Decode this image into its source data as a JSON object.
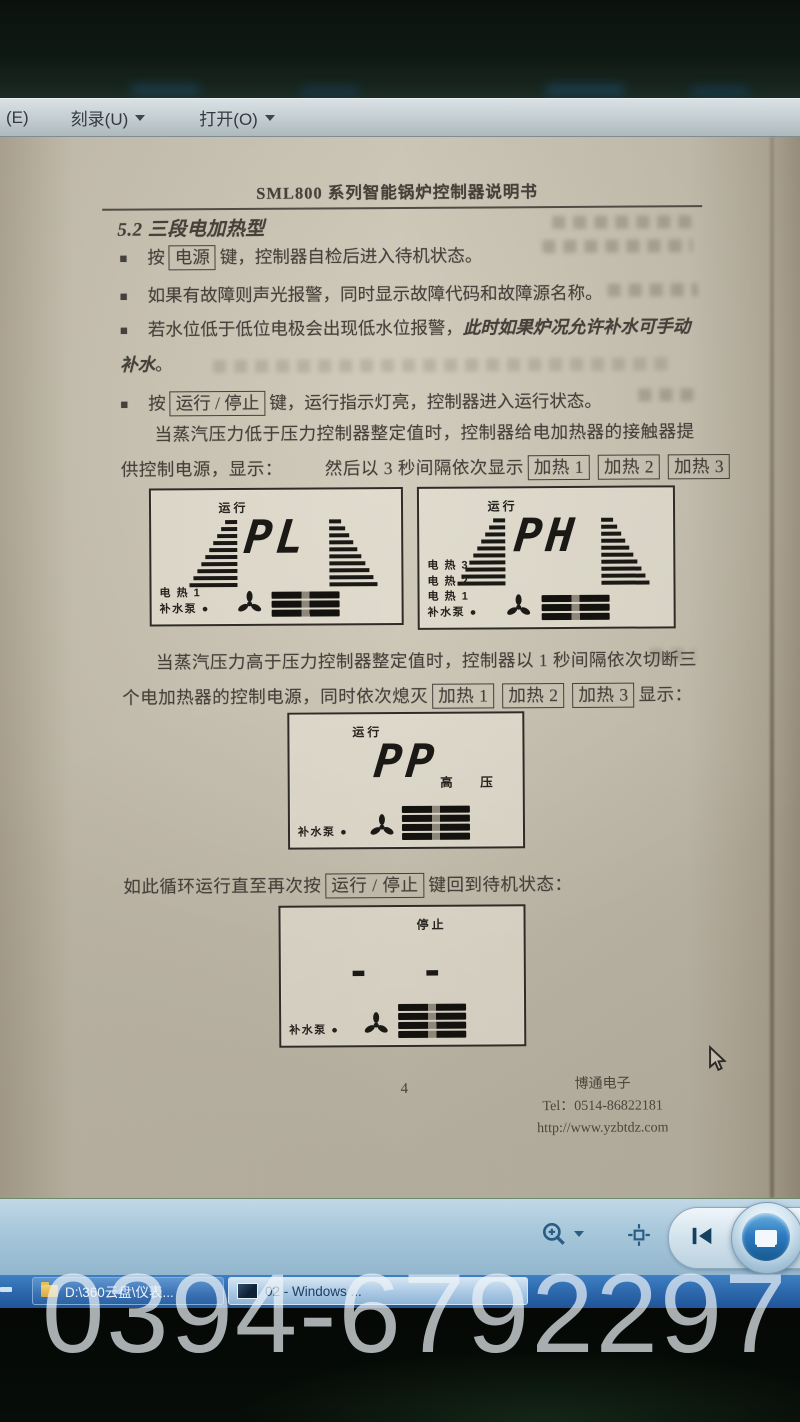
{
  "menu": {
    "items": [
      {
        "label": "(E)"
      },
      {
        "label": "刻录(U)"
      },
      {
        "label": "打开(O)"
      }
    ]
  },
  "document": {
    "header_title": "SML800 系列智能锅炉控制器说明书",
    "section_title": "5.2 三段电加热型",
    "bullet_marker": "■",
    "bullets": {
      "power": {
        "pre": "按",
        "box": "电源",
        "post": "键，控制器自检后进入待机状态。"
      },
      "fault": {
        "text": "如果有故障则声光报警，同时显示故障代码和故障源名称。"
      },
      "water": {
        "pre": "若水位低于低位电极会出现低水位报警，",
        "italic": "此时如果炉况允许补水可手动补水",
        "post": "。"
      },
      "run": {
        "pre": "按",
        "box": "运行 / 停止",
        "post": "键，运行指示灯亮，控制器进入运行状态。"
      }
    },
    "para_low": {
      "line1": "当蒸汽压力低于压力控制器整定值时，控制器给电加热器的接触器提",
      "line2_pre": "供控制电源，显示：",
      "line2_mid": "然后以 3 秒间隔依次显示",
      "boxes": [
        "加热 1",
        "加热 2",
        "加热 3"
      ]
    },
    "para_high": {
      "line1": "当蒸汽压力高于压力控制器整定值时，控制器以 1 秒间隔依次切断三",
      "line2_pre": "个电加热器的控制电源，同时依次熄灭",
      "boxes": [
        "加热 1",
        "加热 2",
        "加热 3"
      ],
      "line2_post": "显示："
    },
    "loop_line": {
      "pre": "如此循环运行直至再次按",
      "box": "运行 / 停止",
      "post": "键回到待机状态："
    },
    "footer": {
      "page_number": "4",
      "company": "博通电子",
      "tel": "Tel：0514-86822181",
      "url": "http://www.yzbtdz.com"
    }
  },
  "lcd_panels": [
    {
      "status": "运行",
      "value": "PL",
      "labels": [
        "电 热 1",
        "补水泵 ●"
      ],
      "right_label": "",
      "heater_bars": 3
    },
    {
      "status": "运行",
      "value": "PH",
      "labels": [
        "电 热 3",
        "电 热 2",
        "电 热 1",
        "补水泵 ●"
      ],
      "right_label": "",
      "heater_bars": 3
    },
    {
      "status": "运行",
      "value": "PP",
      "labels": [
        "补水泵 ●"
      ],
      "right_label": "高 压",
      "heater_bars": 4
    },
    {
      "status": "停止",
      "value": "- -",
      "labels": [
        "补水泵 ●"
      ],
      "right_label": "",
      "heater_bars": 4
    }
  ],
  "taskbar": {
    "buttons": [
      {
        "label": "D:\\360云盘\\仪表..."
      },
      {
        "label": "02 - Windows ..."
      }
    ]
  },
  "watermark": {
    "text": "0394-6792297"
  }
}
